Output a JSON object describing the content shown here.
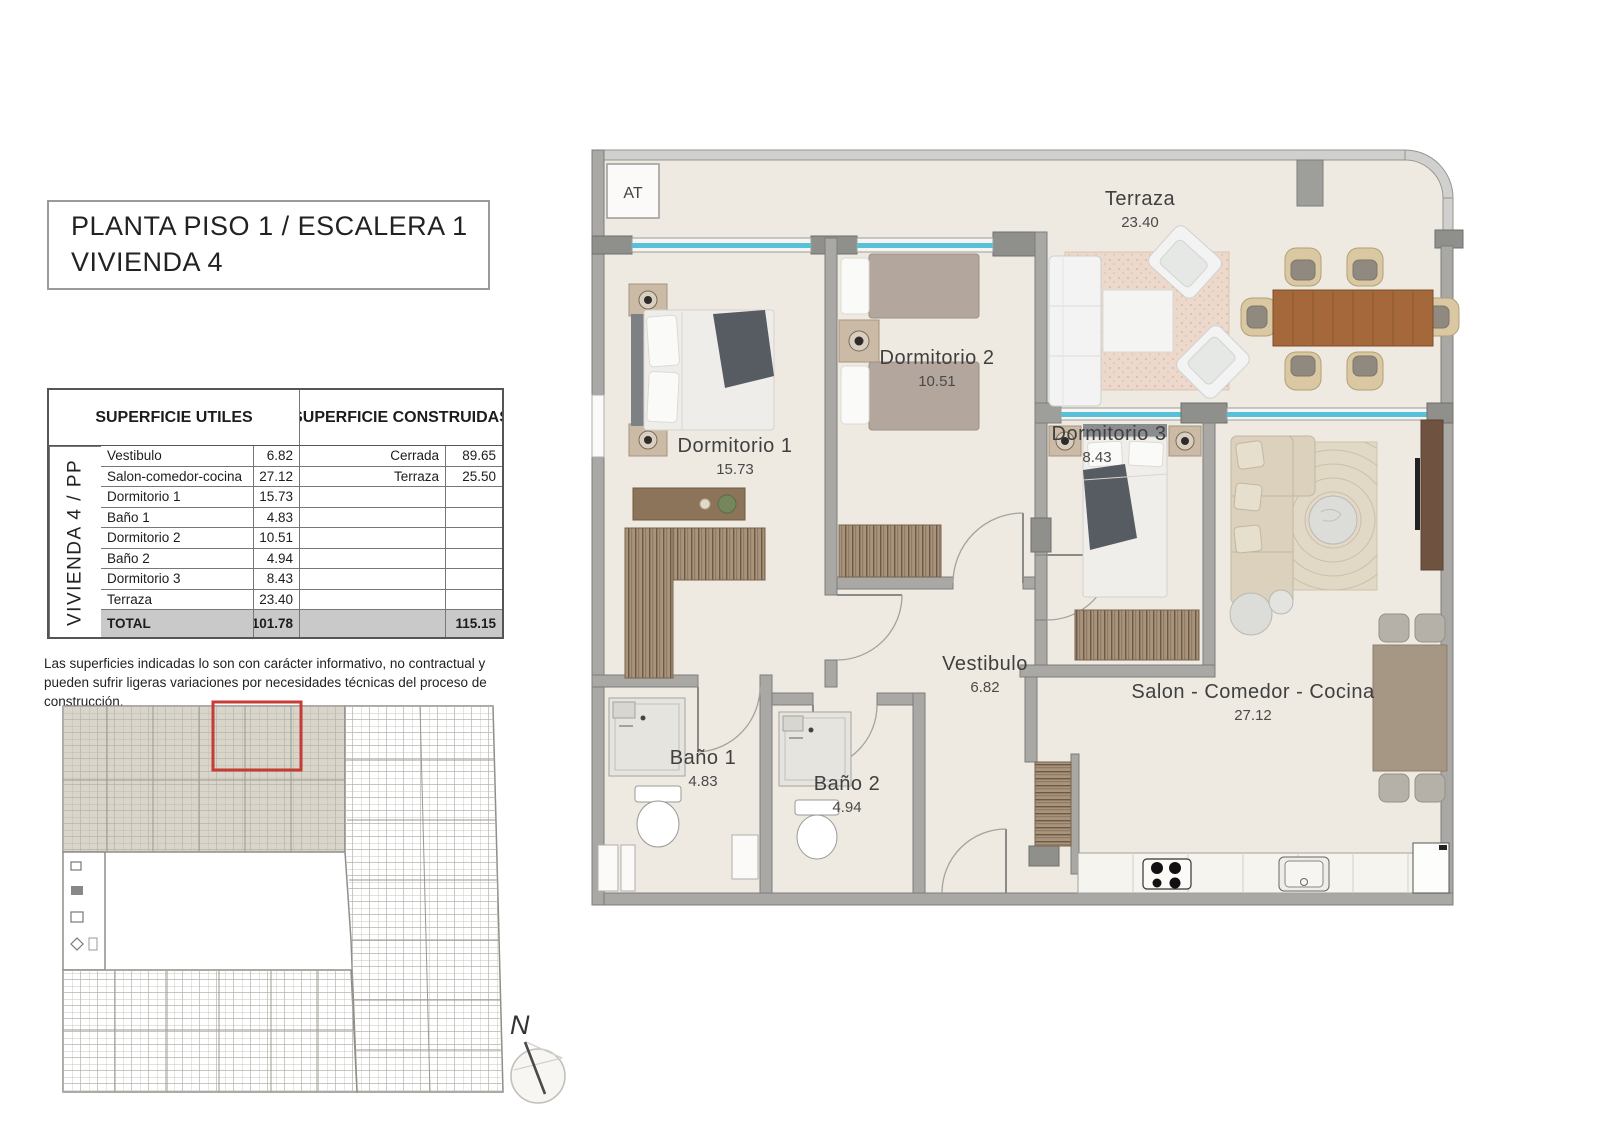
{
  "panel": {
    "title": {
      "line1": "PLANTA PISO 1 / ESCALERA 1",
      "line2": "VIVIENDA 4"
    },
    "table": {
      "header_utiles": "SUPERFICIE UTILES",
      "header_construidas": "SUPERFICIE CONSTRUIDAS",
      "vertical_label": "VIVIENDA 4 / PP",
      "useful_rows": [
        {
          "name": "Vestibulo",
          "value": "6.82"
        },
        {
          "name": "Salon-comedor-cocina",
          "value": "27.12"
        },
        {
          "name": "Dormitorio 1",
          "value": "15.73"
        },
        {
          "name": "Baño 1",
          "value": "4.83"
        },
        {
          "name": "Dormitorio 2",
          "value": "10.51"
        },
        {
          "name": "Baño 2",
          "value": "4.94"
        },
        {
          "name": "Dormitorio  3",
          "value": "8.43"
        },
        {
          "name": "Terraza",
          "value": "23.40"
        }
      ],
      "built_rows": [
        {
          "name": "Cerrada",
          "value": "89.65"
        },
        {
          "name": "Terraza",
          "value": "25.50"
        }
      ],
      "total_label": "TOTAL",
      "total_useful": "101.78",
      "total_built": "115.15"
    },
    "disclaimer": "Las superficies indicadas lo son con carácter informativo, no contractual y pueden sufrir ligeras variaciones por necesidades técnicas del proceso de construcción.",
    "compass": {
      "north_label": "N"
    }
  },
  "plan": {
    "at_label": "AT",
    "rooms": {
      "terraza": {
        "name": "Terraza",
        "area": "23.40"
      },
      "dormitorio1": {
        "name": "Dormitorio 1",
        "area": "15.73"
      },
      "dormitorio2": {
        "name": "Dormitorio 2",
        "area": "10.51"
      },
      "dormitorio3": {
        "name": "Dormitorio 3",
        "area": "8.43"
      },
      "vestibulo": {
        "name": "Vestibulo",
        "area": "6.82"
      },
      "bano1": {
        "name": "Baño 1",
        "area": "4.83"
      },
      "bano2": {
        "name": "Baño 2",
        "area": "4.94"
      },
      "salon": {
        "name": "Salon - Comedor - Cocina",
        "area": "27.12"
      }
    }
  },
  "colors": {
    "wall": "#a9a8a5",
    "wall_dark": "#8f8f8c",
    "floor": "#eeeae1",
    "window": "#58c1d9",
    "highlight_red": "#c63b33",
    "wood": "#a4683a",
    "wardrobe": "#a8947c"
  }
}
